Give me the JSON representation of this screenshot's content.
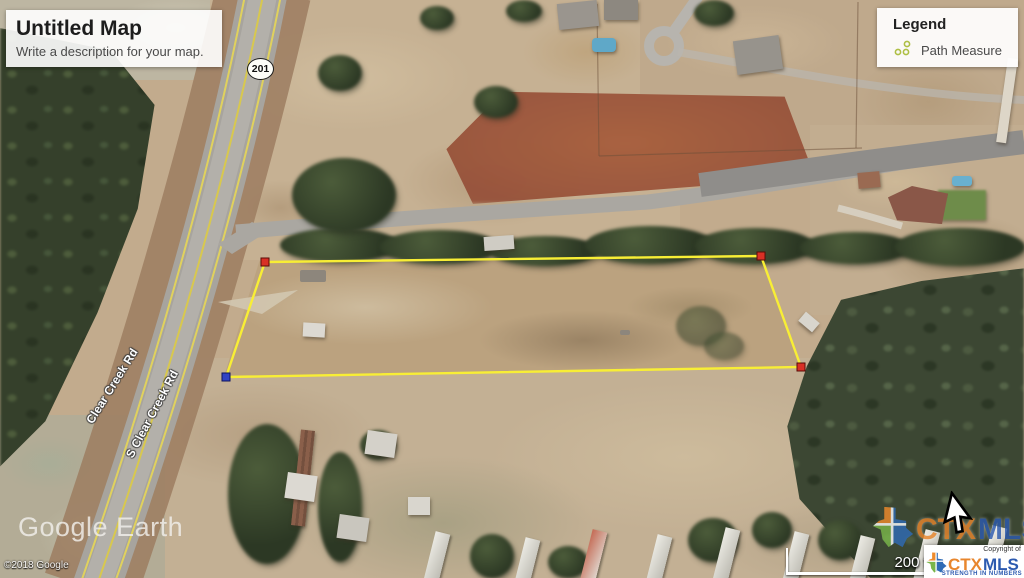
{
  "title_card": {
    "title": "Untitled Map",
    "description": "Write a description for your map."
  },
  "legend": {
    "title": "Legend",
    "items": [
      {
        "icon": "path-measure-icon",
        "label": "Path Measure"
      }
    ]
  },
  "map": {
    "route_shield": "201",
    "street_labels": [
      "Clear Creek Rd",
      "S Clear Creek Rd"
    ],
    "parcel": {
      "outline_color": "#f8ee35",
      "vertices": [
        {
          "x": 265,
          "y": 262,
          "marker": "red"
        },
        {
          "x": 761,
          "y": 256,
          "marker": "red"
        },
        {
          "x": 801,
          "y": 367,
          "marker": "red"
        },
        {
          "x": 226,
          "y": 377,
          "marker": "blue"
        }
      ]
    }
  },
  "scale_bar": {
    "label": "200 ft"
  },
  "watermarks": {
    "google_earth": "Google Earth",
    "google_copyright": "©2018 Google",
    "ctxmls": {
      "ctx": "CTX",
      "mls": "MLS"
    },
    "mls_badge": {
      "copyright_of": "Copyright of",
      "ctx": "CTX",
      "mls": "MLS",
      "tagline": "STRENGTH IN NUMBERS"
    }
  },
  "colors": {
    "parcel-line": "#f8ee35",
    "vertex-red": "#d93025",
    "vertex-blue": "#3143c4",
    "ctx-orange": "#e8862d",
    "mls-blue": "#2d5bb0"
  }
}
